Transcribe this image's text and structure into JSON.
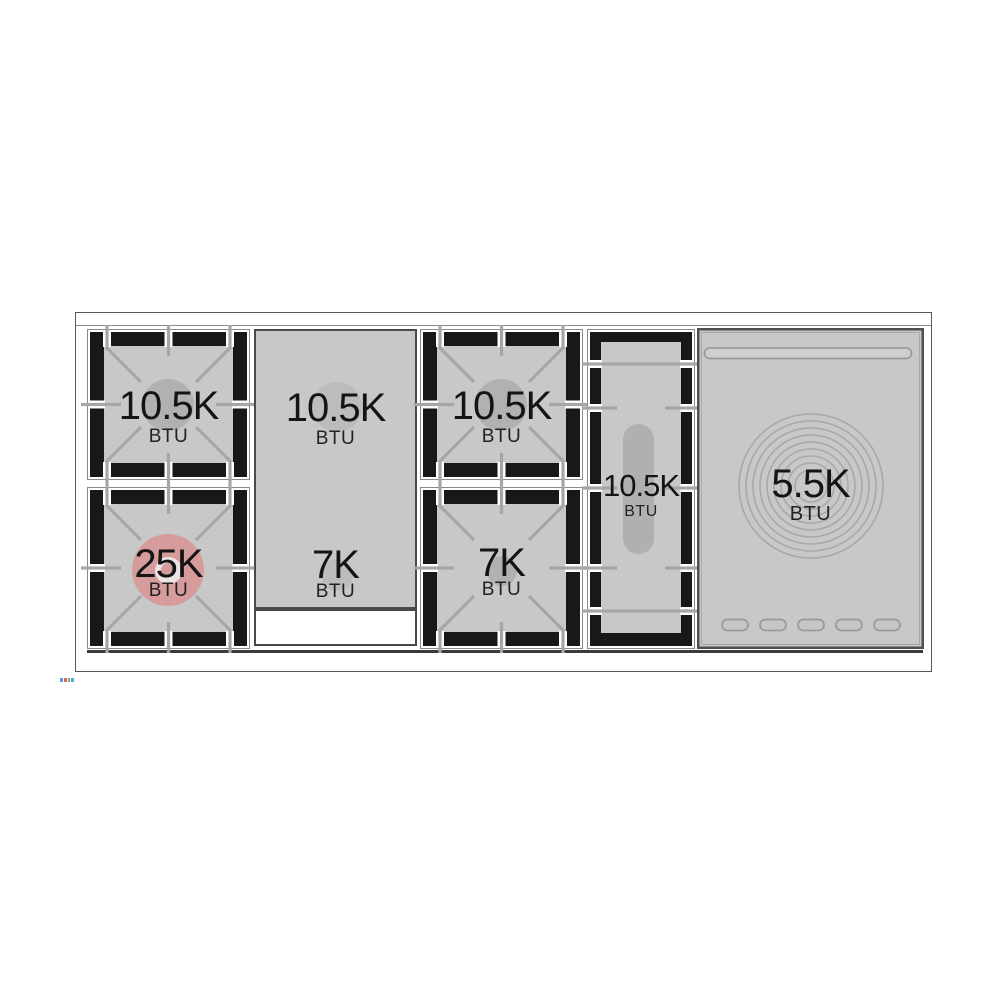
{
  "diagram": {
    "name": "Range cooktop burner BTU layout",
    "burners": {
      "left_top": {
        "value": "10.5K",
        "unit": "BTU"
      },
      "left_bottom": {
        "value": "25K",
        "unit": "BTU"
      },
      "griddle_top": {
        "value": "10.5K",
        "unit": "BTU"
      },
      "griddle_bottom": {
        "value": "7K",
        "unit": "BTU"
      },
      "center_top": {
        "value": "10.5K",
        "unit": "BTU"
      },
      "center_bottom": {
        "value": "7K",
        "unit": "BTU"
      },
      "oval": {
        "value": "10.5K",
        "unit": "BTU"
      },
      "simmer_plate": {
        "value": "5.5K",
        "unit": "BTU"
      }
    },
    "colors": {
      "surface_gray": "#c8c8c8",
      "grate_frame_black": "#181818",
      "grate_line_gray": "#a6a6a6",
      "burner_cap_gray": "#b1b1b1",
      "power_burner_pink": "#d69c9c",
      "outline_gray": "#8a8a8a",
      "panel_border_dark": "#4a4a4a",
      "text_black": "#141414"
    }
  }
}
